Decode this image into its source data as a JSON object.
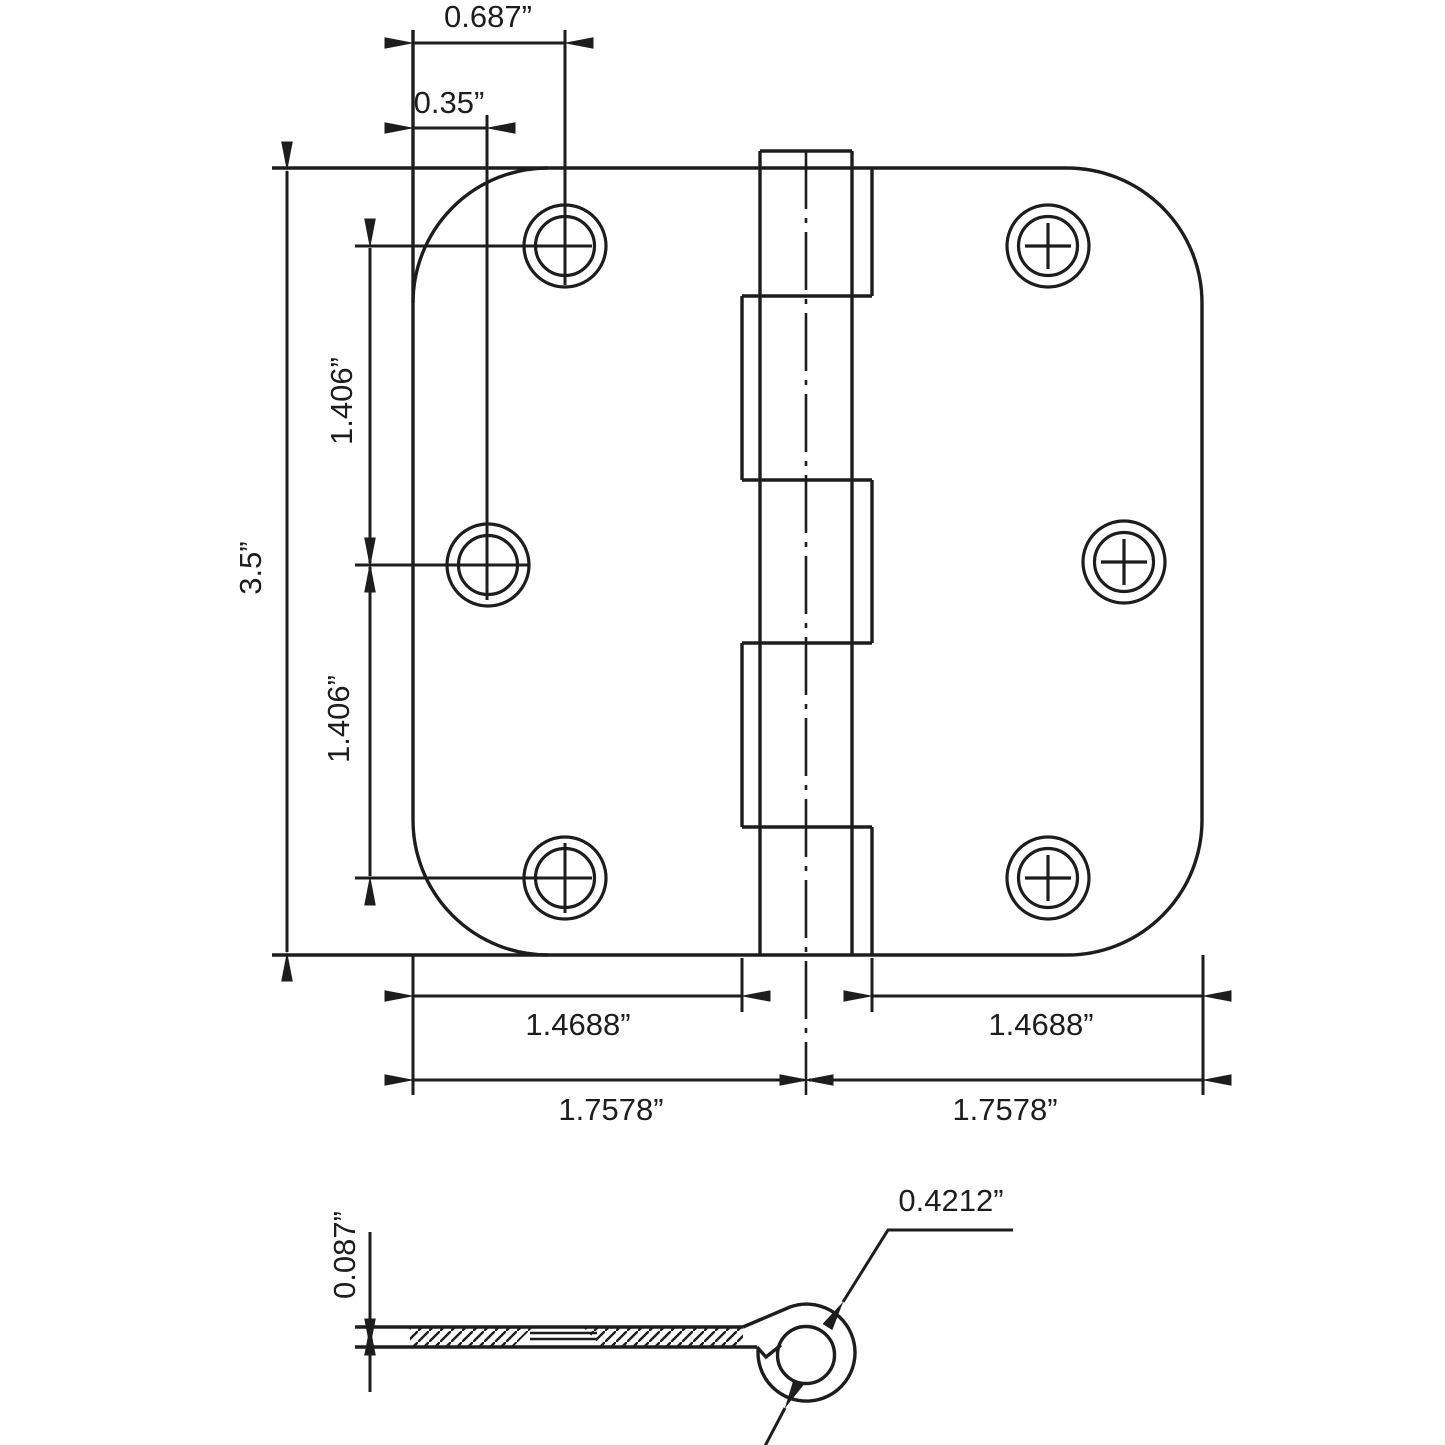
{
  "drawing": {
    "colors": {
      "ink": "#1d1d1d",
      "background": "#ffffff"
    },
    "face_view": {
      "description": "hinge face view with six screw holes and five-knuckle barrel",
      "dims": {
        "top_hole_inset": "0.687”",
        "mid_hole_inset": "0.35”",
        "leaf_height": "3.5”",
        "hole_pitch_upper": "1.406”",
        "hole_pitch_lower": "1.406”",
        "leaf_flat_left": "1.4688”",
        "leaf_flat_right": "1.4688”",
        "half_span_left": "1.7578”",
        "half_span_right": "1.7578”"
      }
    },
    "edge_view": {
      "description": "hinge edge section with curled knuckle",
      "dims": {
        "leaf_thickness": "0.087”",
        "knuckle_diameter": "0.4212”"
      }
    }
  }
}
